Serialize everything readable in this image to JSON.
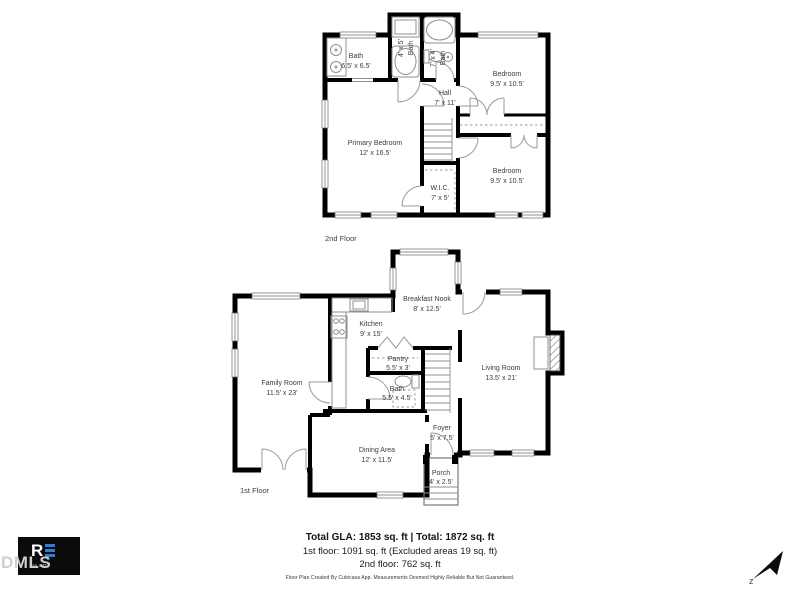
{
  "floors": {
    "second": {
      "label": "2nd Floor",
      "rooms": {
        "bath_main": {
          "name": "Bath",
          "dims": "6.5' x 6.5'"
        },
        "bath_small_left": {
          "name": "Bath",
          "dims": "4' x 5'"
        },
        "bath_small_right": {
          "name": "Bath",
          "dims": "7' x 4'"
        },
        "bedroom_top": {
          "name": "Bedroom",
          "dims": "9.5' x 10.5'"
        },
        "hall": {
          "name": "Hall",
          "dims": "7' x 11'"
        },
        "primary_bedroom": {
          "name": "Primary Bedroom",
          "dims": "12' x 16.5'"
        },
        "wic": {
          "name": "W.I.C.",
          "dims": "7' x 5'"
        },
        "bedroom_bottom": {
          "name": "Bedroom",
          "dims": "9.5' x 10.5'"
        }
      }
    },
    "first": {
      "label": "1st Floor",
      "rooms": {
        "breakfast_nook": {
          "name": "Breakfast Nook",
          "dims": "8' x 12.5'"
        },
        "kitchen": {
          "name": "Kitchen",
          "dims": "9' x 15'"
        },
        "pantry": {
          "name": "Pantry",
          "dims": "5.5' x 3'"
        },
        "bath": {
          "name": "Bath",
          "dims": "5.5' x 4.5'"
        },
        "family_room": {
          "name": "Family Room",
          "dims": "11.5' x 23'"
        },
        "living_room": {
          "name": "Living Room",
          "dims": "13.5' x 21'"
        },
        "dining_area": {
          "name": "Dining Area",
          "dims": "12' x 11.5'"
        },
        "foyer": {
          "name": "Foyer",
          "dims": "5' x 7.5'"
        },
        "porch": {
          "name": "Porch",
          "dims": "4' x 2.5'"
        }
      }
    }
  },
  "summary": {
    "total_line": "Total GLA: 1853 sq. ft | Total: 1872 sq. ft",
    "first_floor_line": "1st floor: 1091 sq. ft (Excluded areas 19 sq. ft)",
    "second_floor_line": "2nd floor: 762 sq. ft",
    "disclaimer": "Floor Plan Created By Cubicasa App. Measurements Deemed Highly Reliable But Not Guaranteed."
  },
  "branding": {
    "watermark": "DMLS",
    "logo_letter": "R",
    "logo_subtext": "VA CO"
  },
  "compass": {
    "north_label": "z"
  },
  "colors": {
    "wall": "#000000",
    "label_text": "#3c3c3c",
    "logo_blue": "#2e7fd4",
    "watermark_gray": "#cfcfcf"
  }
}
